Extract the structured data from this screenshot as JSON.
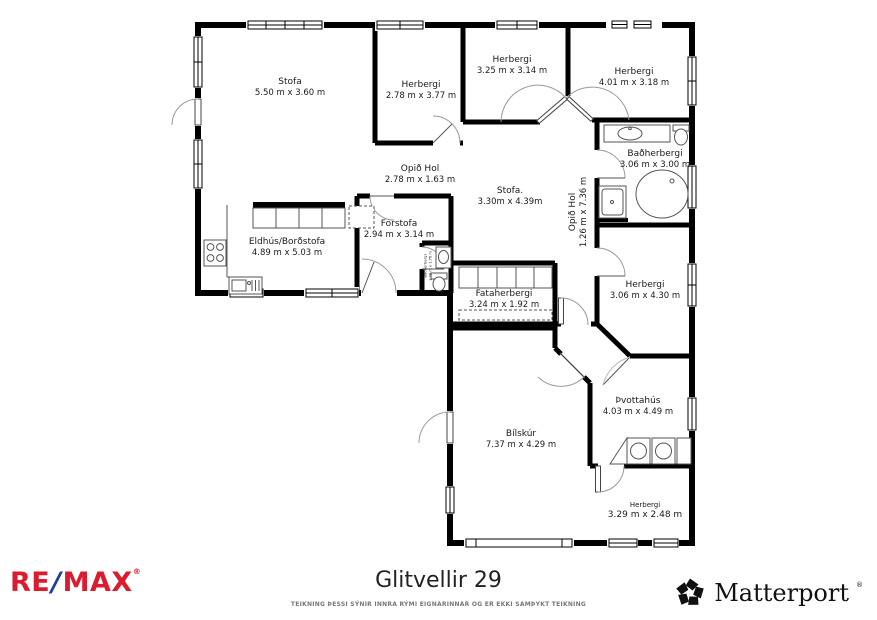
{
  "plan": {
    "rooms": [
      {
        "name": "Stofa",
        "dims": "5.50 m x 3.60 m"
      },
      {
        "name": "Herbergi",
        "dims": "2.78 m x 3.77 m"
      },
      {
        "name": "Herbergi",
        "dims": "3.25 m x 3.14 m"
      },
      {
        "name": "Herbergi",
        "dims": "4.01 m x 3.18 m"
      },
      {
        "name": "Baðherbergi",
        "dims": "3.06 m x 3.00 m"
      },
      {
        "name": "Opið Hol",
        "dims": "2.78 m x 1.63 m"
      },
      {
        "name": "Stofa.",
        "dims": "3.30m x 4.39m"
      },
      {
        "name": "Opið Hol",
        "dims": "1.26 m x 7.36 m"
      },
      {
        "name": "Forstofa",
        "dims": "2.94 m x 3.14 m"
      },
      {
        "name": "Eldhús/Borðstofa",
        "dims": "4.89 m x 5.03 m"
      },
      {
        "name": "Baðherbergi",
        "dims": "1.08 m x 1.76 m"
      },
      {
        "name": "Fataherbergi",
        "dims": "3.24 m x 1.92 m"
      },
      {
        "name": "Herbergi",
        "dims": "3.06 m x 4.30 m"
      },
      {
        "name": "Þvottahús",
        "dims": "4.03 m x 4.49 m"
      },
      {
        "name": "Bílskúr",
        "dims": "7.37 m x 4.29 m"
      },
      {
        "name": "Herbergi",
        "dims": "3.29 m x 2.48 m"
      }
    ]
  },
  "footer": {
    "title": "Glitvellir 29",
    "disclaimer": "TEIKNING ÞESSI SÝNIR INNRA RÝMI EIGNARINNAR OG ER EKKI SAMÞYKT TEIKNING",
    "remax_re": "RE",
    "remax_slash": "/",
    "remax_max": "MAX",
    "remax_reg": "®",
    "matterport_name": "Matterport",
    "matterport_reg": "®"
  },
  "colors": {
    "wall": "#000000",
    "remax_red": "#dc1c2e",
    "remax_blue": "#1741a7"
  }
}
